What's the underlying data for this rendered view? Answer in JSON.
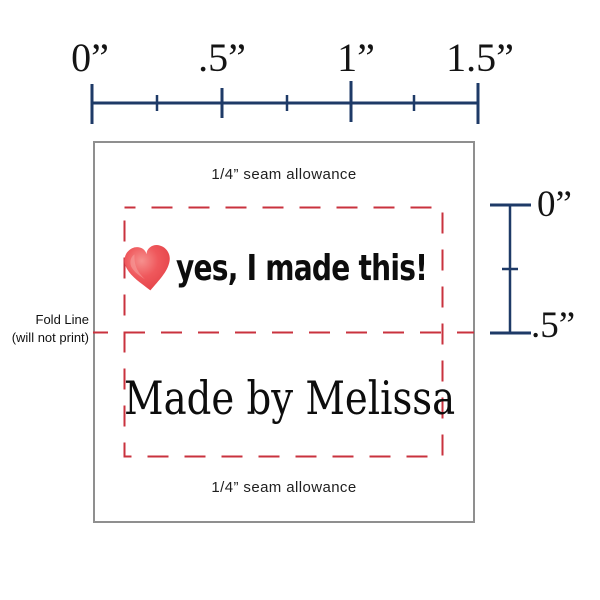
{
  "top_ruler": {
    "labels": [
      "0”",
      ".5”",
      "1”",
      "1.5”"
    ]
  },
  "side_ruler": {
    "labels": [
      "0”",
      ".5”"
    ]
  },
  "fold_note": {
    "line1": "Fold Line",
    "line2": "(will not print)"
  },
  "label": {
    "seam_allowance_top": "1/4” seam allowance",
    "tagline": "yes, I made this!",
    "name_line": "Made by Melissa",
    "seam_allowance_bottom": "1/4” seam allowance"
  },
  "icons": {
    "heart": "heart-icon"
  },
  "colors": {
    "ruler_navy": "#1e3a67",
    "stitch_red": "#c9323e",
    "heart_red": "#ee4b50",
    "border_gray": "#8f8f8f",
    "text_black": "#1b1b1b"
  }
}
